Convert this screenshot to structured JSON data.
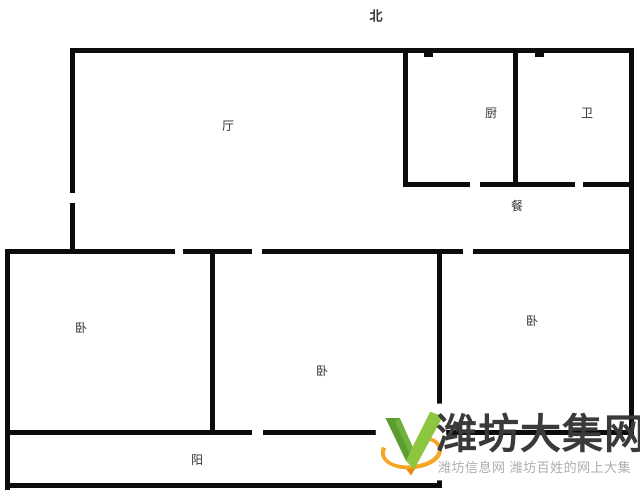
{
  "compass": {
    "label": "北",
    "x": 376,
    "y": 16
  },
  "colors": {
    "wall": "#0c0c0c",
    "background": "#ffffff",
    "room_label": "#333333",
    "brand_text": "#3a3a3a",
    "tagline_text": "#aeaeae",
    "logo_green_light": "#8dc63f",
    "logo_green_dark": "#5a9e32",
    "logo_orange": "#f5a623",
    "logo_orange_dark": "#e98b12"
  },
  "rooms": [
    {
      "id": "living",
      "label": "厅",
      "x": 228,
      "y": 126
    },
    {
      "id": "kitchen",
      "label": "厨",
      "x": 491,
      "y": 113
    },
    {
      "id": "bathroom",
      "label": "卫",
      "x": 587,
      "y": 113
    },
    {
      "id": "dining",
      "label": "餐",
      "x": 517,
      "y": 206
    },
    {
      "id": "bedroom-left",
      "label": "卧",
      "x": 81,
      "y": 328
    },
    {
      "id": "bedroom-middle",
      "label": "卧",
      "x": 322,
      "y": 371
    },
    {
      "id": "bedroom-right",
      "label": "卧",
      "x": 532,
      "y": 321
    },
    {
      "id": "balcony",
      "label": "阳",
      "x": 197,
      "y": 460
    }
  ],
  "walls": [
    {
      "id": "top-outer",
      "x": 70,
      "y": 48,
      "w": 564,
      "h": 5
    },
    {
      "id": "left-upper-a",
      "x": 70,
      "y": 48,
      "w": 5,
      "h": 145
    },
    {
      "id": "left-upper-b",
      "x": 70,
      "y": 203,
      "w": 5,
      "h": 51
    },
    {
      "id": "right-outer",
      "x": 629,
      "y": 48,
      "w": 5,
      "h": 387
    },
    {
      "id": "kitchen-left",
      "x": 403,
      "y": 52,
      "w": 5,
      "h": 135
    },
    {
      "id": "kitchen-bath-divider",
      "x": 513,
      "y": 52,
      "w": 5,
      "h": 135
    },
    {
      "id": "kitchen-dining-a",
      "x": 403,
      "y": 182,
      "w": 67,
      "h": 5
    },
    {
      "id": "kitchen-dining-b",
      "x": 480,
      "y": 182,
      "w": 95,
      "h": 5
    },
    {
      "id": "kitchen-dining-c",
      "x": 583,
      "y": 182,
      "w": 51,
      "h": 5
    },
    {
      "id": "flue-tick-kitchen",
      "x": 424,
      "y": 53,
      "w": 9,
      "h": 4
    },
    {
      "id": "flue-tick-bath",
      "x": 535,
      "y": 53,
      "w": 9,
      "h": 4
    },
    {
      "id": "mid-a",
      "x": 8,
      "y": 249,
      "w": 167,
      "h": 5
    },
    {
      "id": "mid-b",
      "x": 183,
      "y": 249,
      "w": 69,
      "h": 5
    },
    {
      "id": "mid-c",
      "x": 262,
      "y": 249,
      "w": 201,
      "h": 5
    },
    {
      "id": "mid-d",
      "x": 473,
      "y": 249,
      "w": 161,
      "h": 5
    },
    {
      "id": "left-lower",
      "x": 5,
      "y": 249,
      "w": 5,
      "h": 241
    },
    {
      "id": "bedroom-divider",
      "x": 210,
      "y": 249,
      "w": 5,
      "h": 186
    },
    {
      "id": "bedroom-mid-right",
      "x": 437,
      "y": 249,
      "w": 5,
      "h": 239
    },
    {
      "id": "bedroom-bottom-a",
      "x": 8,
      "y": 430,
      "w": 244,
      "h": 5
    },
    {
      "id": "bedroom-bottom-b",
      "x": 263,
      "y": 430,
      "w": 371,
      "h": 5
    },
    {
      "id": "balcony-bottom",
      "x": 5,
      "y": 483,
      "w": 437,
      "h": 5
    }
  ],
  "watermark": {
    "brand": "潍坊大集网",
    "tagline": "潍坊信息网 潍坊百姓的网上大集"
  }
}
